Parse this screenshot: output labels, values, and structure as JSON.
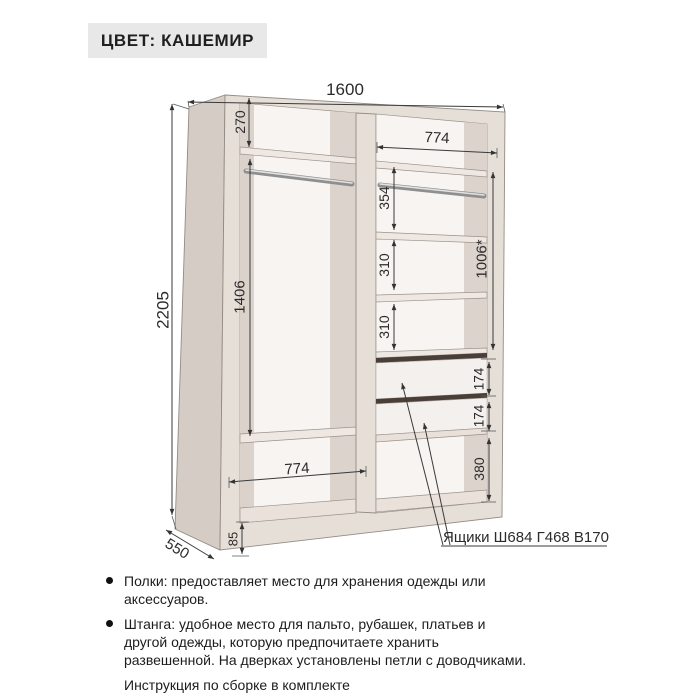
{
  "title": {
    "label": "ЦВЕТ: КАШЕМИР"
  },
  "drawing": {
    "dims": {
      "total_width": "1600",
      "total_height": "2205",
      "depth": "550",
      "top_shelf": "270",
      "top_right_width": "774",
      "rod_section": "354",
      "gap1": "310",
      "gap2": "310",
      "right_total": "1006*",
      "left_hanging": "1406",
      "drawer1": "174",
      "drawer2": "174",
      "bottom_open": "380",
      "bottom_left_width": "774",
      "plinth": "85"
    },
    "drawer_label": "Ящики Ш684 Г468 В170",
    "colors": {
      "carcass": "#e6dfd8",
      "side_panel": "#d5ccc5",
      "back": "#f7f4f1",
      "drawer_gap": "#4a3f38"
    }
  },
  "features": [
    {
      "bullet": true,
      "lines": [
        "Полки: предоставляет место для хранения одежды или",
        "аксессуаров."
      ]
    },
    {
      "bullet": true,
      "lines": [
        "Штанга: удобное место для пальто, рубашек, платьев и",
        "другой одежды, которую предпочитаете хранить",
        "развешенной. На дверках установлены петли с доводчиками."
      ]
    },
    {
      "bullet": false,
      "lines": [
        "Инструкция по сборке в комплекте"
      ]
    }
  ]
}
